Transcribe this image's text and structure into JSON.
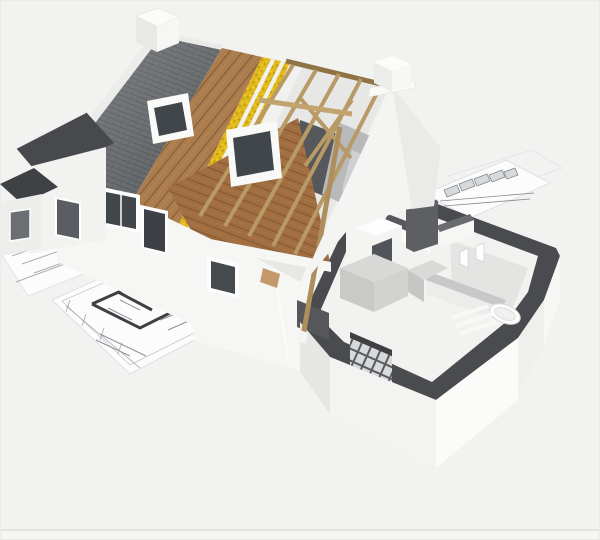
{
  "description": "3D rendering of a house under construction, cut away to show building layers: slate roof tiles, timber sheathing, yellow insulation, exposed rafters, wooden attic floor, and a ground-floor plan cutaway with kitchen and bathroom, standing on architectural blueprint sheets.",
  "scene": {
    "objects": [
      "blueprint-sheets",
      "floor-plan-drawing",
      "elevation-drawing",
      "chimney",
      "slate-roof",
      "timber-sheathing",
      "insulation-layer",
      "rafter-truss",
      "attic-floor",
      "skylight",
      "dormer-wing",
      "front-wall-windows",
      "stepped-gable",
      "ground-floor-cutaway",
      "kitchen-units",
      "bathtub",
      "glass-block-wall"
    ]
  },
  "colors": {
    "background": "#f2f2f0",
    "ground_line": "#e2e2e0",
    "sheet": "#fcfcfc",
    "sheet_edge": "#dfe0e2",
    "plan_line": "#a9aeb4",
    "plan_dark": "#3e4144",
    "hatch_band": "#d7d9da",
    "slate": "#5b5e62",
    "slate_line": "#494c50",
    "ridge_cap": "#e9e9e8",
    "wood": "#aa7c4e",
    "wood_line": "#875c34",
    "insulation": "#e2b91c",
    "insulation_dot": "#bf9a0c",
    "insulation_hi": "#f3d33a",
    "sheathing_white": "#f1f1ef",
    "batten_tan": "#c8a870",
    "bay_interior": "#e7e7e6",
    "opening_dark": "#56585b",
    "slab_gray": "#b8b9ba",
    "attic_floor": "#a06e41",
    "attic_floor_line": "#83552c",
    "fascia": "#f6f6f5",
    "rafter": "#b79a66",
    "rafter_dark": "#8f7344",
    "wall_white": "#f6f6f5",
    "wall_bright": "#fbfbfa",
    "wall_shade": "#e6e6e4",
    "wall_dark_face": "#55575a",
    "glass_dark": "#41464b",
    "dark_roof": "#47494c",
    "dark_roof2": "#3f4245",
    "cut_top": "#4a4b4e",
    "interior_floor": "#f2f2f1",
    "interior_shadow": "#e4e4e3",
    "partition_top": "#57585b",
    "counter": "#d8d8d7",
    "counter_face": "#c9c9c8",
    "unit_dark": "#515458",
    "tall_slab": "#5d5f62",
    "block_joint": "#595b5e",
    "block_cell": "#d8d9da",
    "fixture_white": "#fdfdfd"
  }
}
